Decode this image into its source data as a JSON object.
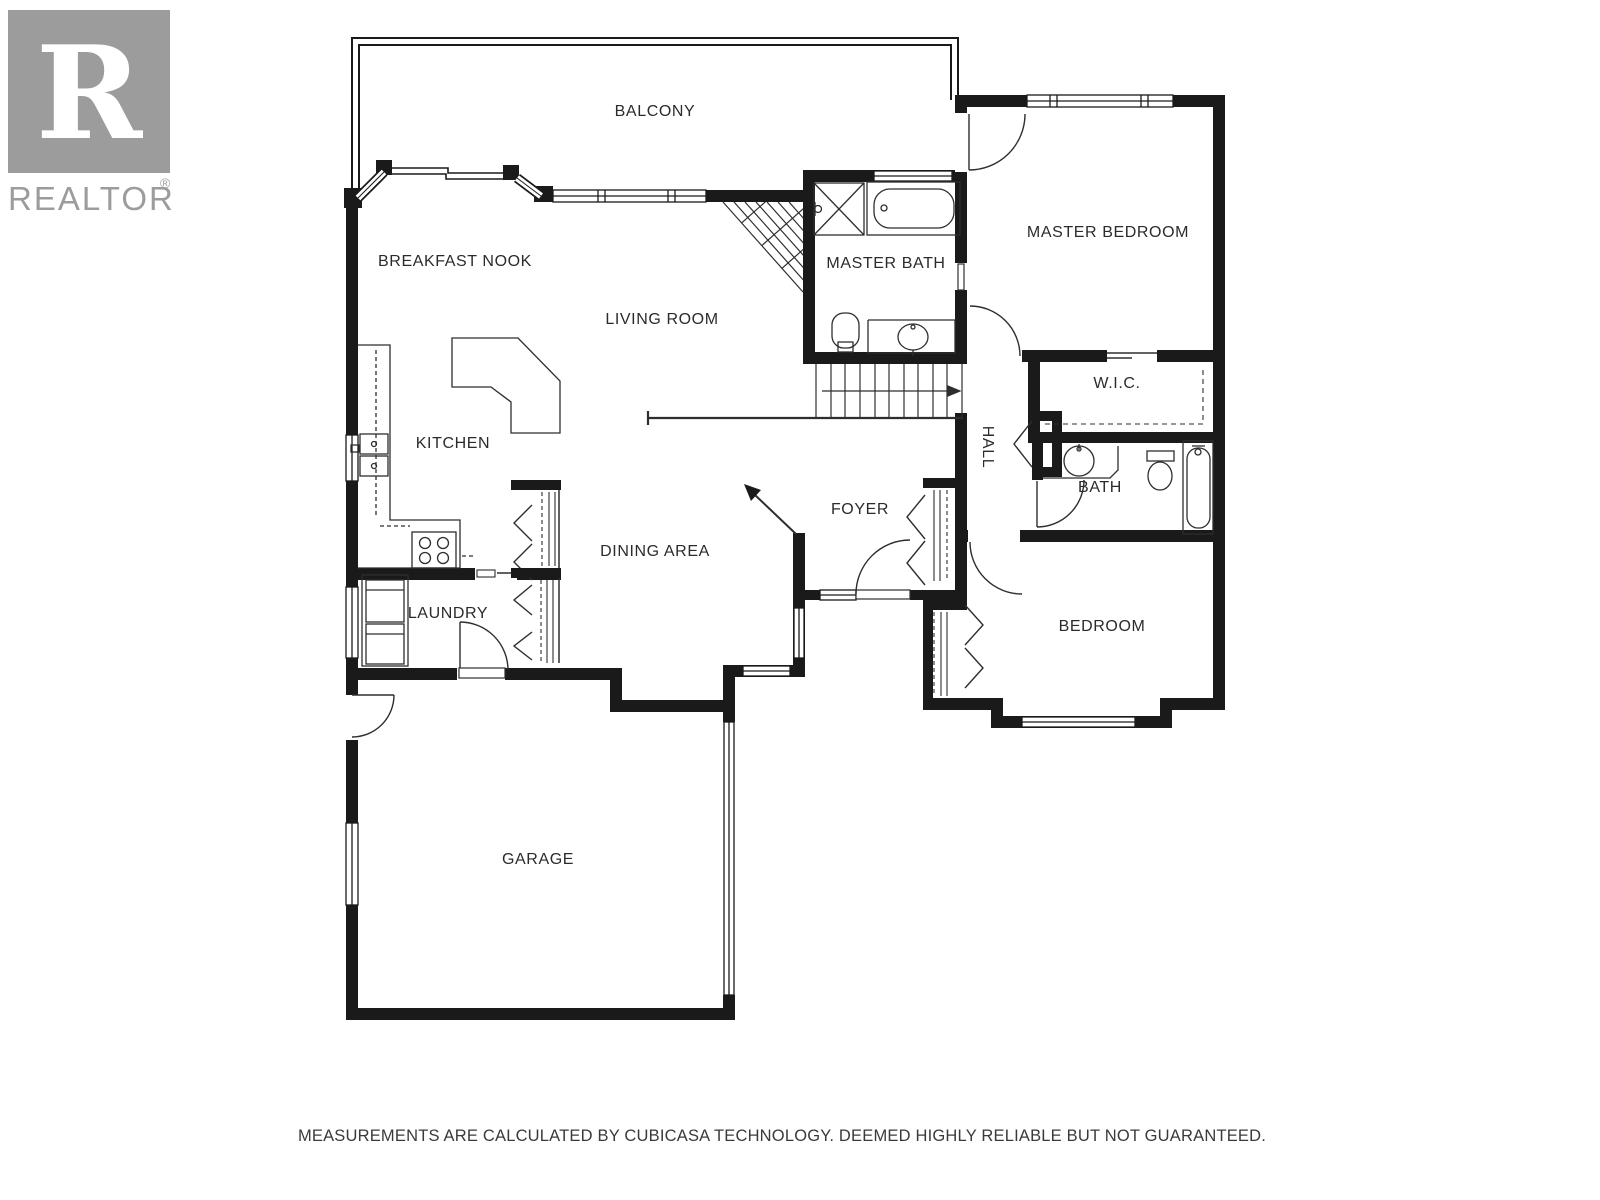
{
  "branding": {
    "logo_letter": "R",
    "wordmark": "REALTOR",
    "registered_mark": "®",
    "logo_color": "#9c9c9c"
  },
  "rooms": [
    {
      "label": "BALCONY"
    },
    {
      "label": "MASTER BEDROOM"
    },
    {
      "label": "BREAKFAST NOOK"
    },
    {
      "label": "MASTER BATH"
    },
    {
      "label": "LIVING ROOM"
    },
    {
      "label": "W.I.C."
    },
    {
      "label": "KITCHEN"
    },
    {
      "label": "HALL"
    },
    {
      "label": "FOYER"
    },
    {
      "label": "BATH"
    },
    {
      "label": "DINING AREA"
    },
    {
      "label": "LAUNDRY"
    },
    {
      "label": "BEDROOM"
    },
    {
      "label": "GARAGE"
    }
  ],
  "fixtures": [
    "shower",
    "bathtub",
    "toilet",
    "vanity-sink",
    "kitchen-sink",
    "stove",
    "washer-dryer",
    "kitchen-island",
    "stairs-up-arrow",
    "stairwell-hatch",
    "entry-direction-arrow",
    "closet-bifold",
    "wardrobe-rod"
  ],
  "disclaimer": "MEASUREMENTS ARE CALCULATED BY CUBICASA TECHNOLOGY. DEEMED HIGHLY RELIABLE BUT NOT GUARANTEED.",
  "colors": {
    "wall": "#1a1a1a",
    "fixture_line": "#2e2e2e",
    "logo_gray": "#9c9c9c",
    "background": "#ffffff"
  }
}
